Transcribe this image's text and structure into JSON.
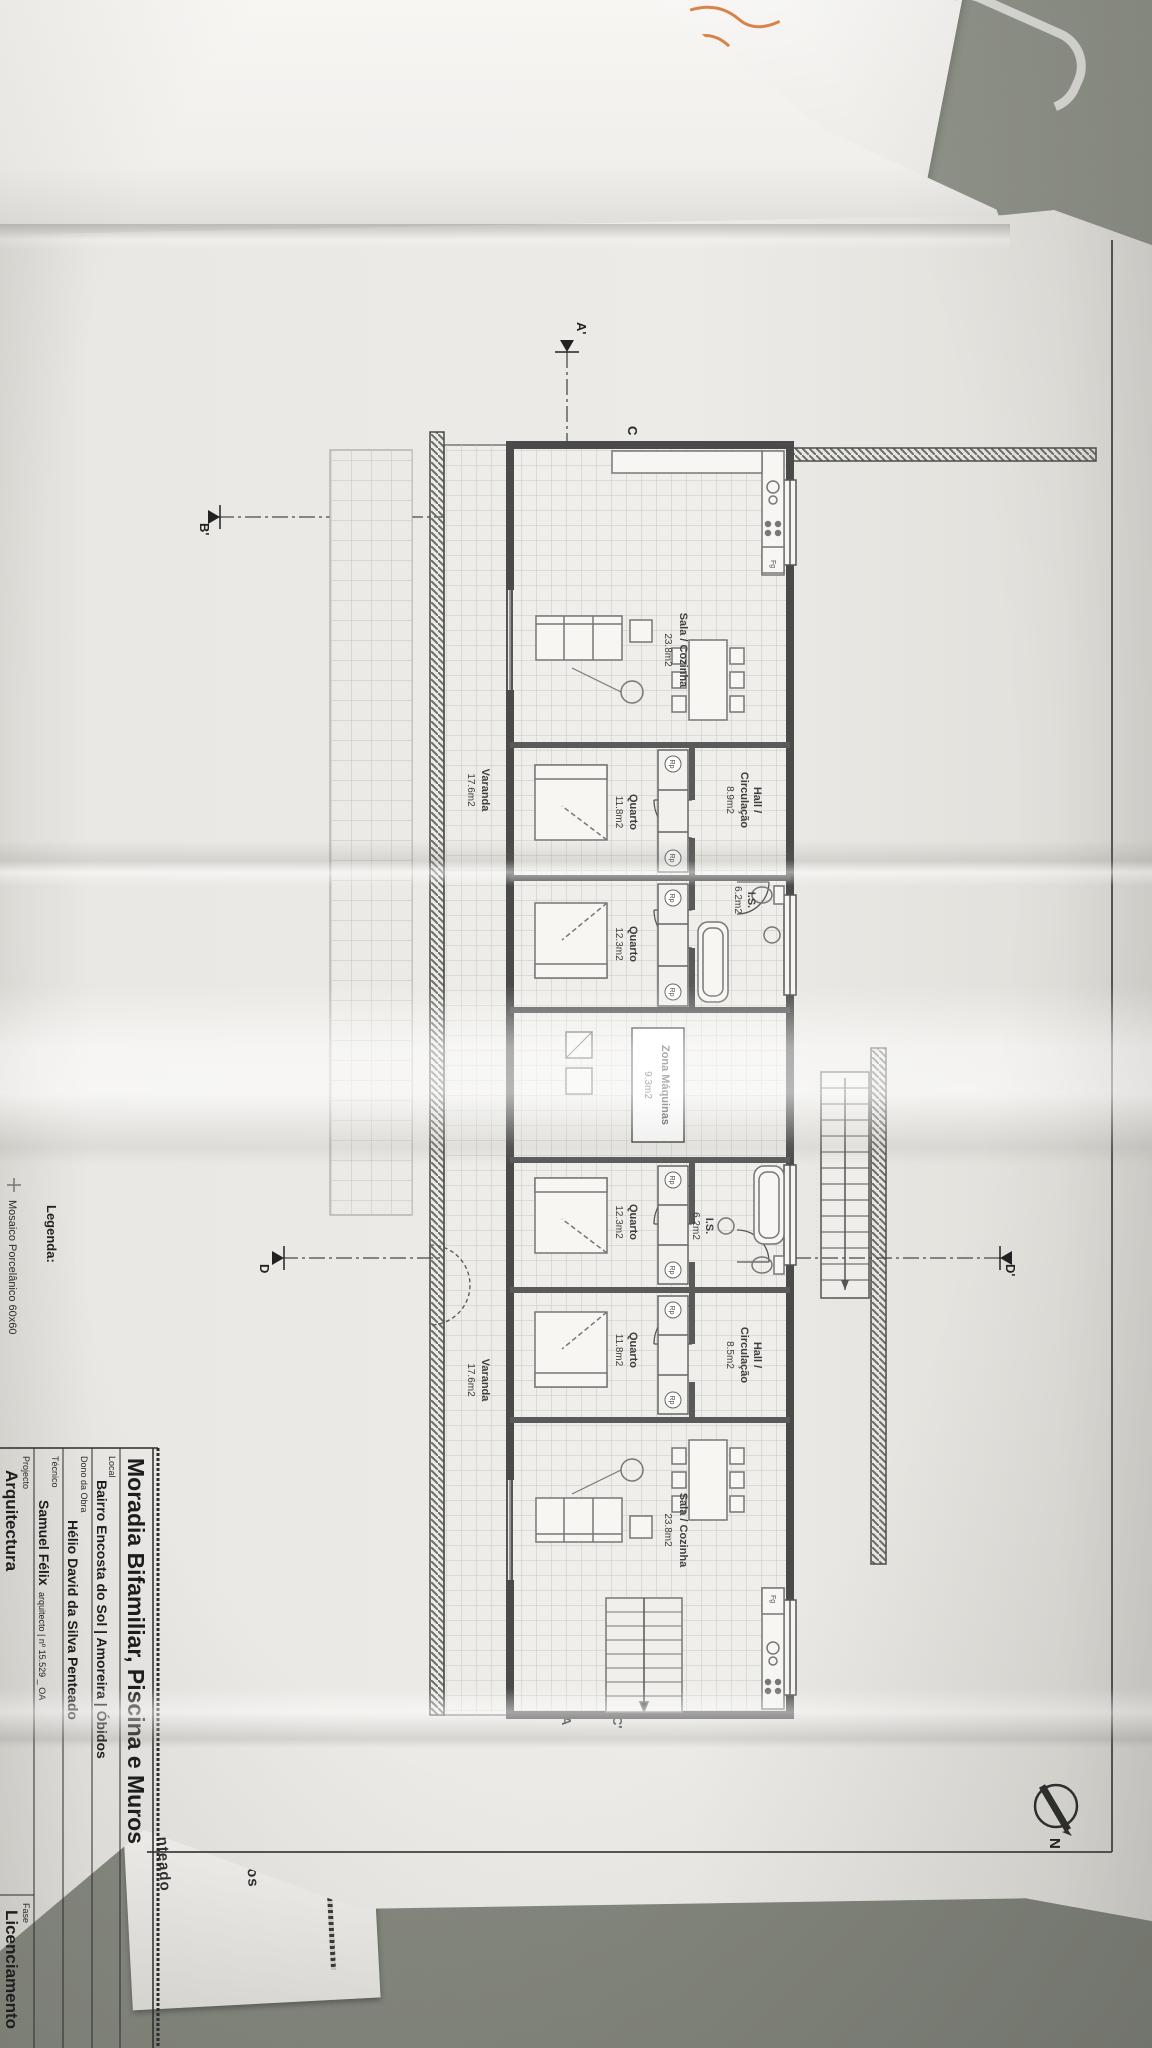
{
  "photo": {
    "desk_color": "#8b8e84",
    "paper_color": "#edebe7",
    "note_color": "#d9834a"
  },
  "sheet": {
    "north_label": "N",
    "legend": {
      "heading": "Legenda:",
      "item_1": "Mosaico Porcelânico 60x60"
    },
    "title_block": {
      "title": "Moradia Bifamiliar, Piscina e Muros",
      "local_label": "Local",
      "local_value": "Bairro Encosta do Sol | Amoreira | Óbidos",
      "dono_label": "Dono da Obra",
      "dono_value": "Hélio David da Silva Penteado",
      "tecnico_label": "Técnico",
      "tecnico_name": "Samuel Félix",
      "tecnico_detail": "arquitecto | nº 15.529 _ OA",
      "projecto_label": "Projecto",
      "projecto_value": "Arquitectura",
      "fase_label": "Fase",
      "fase_value": "Licenciamento"
    },
    "under_sheet": {
      "fragment_1": "Óbidos",
      "fragment_2": "nteado"
    }
  },
  "plan": {
    "codes": {
      "wardrobe": "Rp",
      "fridge": "Fg"
    },
    "zona": {
      "name": "Zona Máquinas",
      "area": "9.3m2"
    },
    "unit_a": {
      "sala": {
        "name": "Sala / Cozinha",
        "area": "23.8m2"
      },
      "hall": {
        "name_1": "Hall /",
        "name_2": "Circulação",
        "area": "8.9m2"
      },
      "quarto_1": {
        "name": "Quarto",
        "area": "11.8m2"
      },
      "quarto_2": {
        "name": "Quarto",
        "area": "12.3m2"
      },
      "is": {
        "name": "I.S.",
        "area": "6.2m2"
      },
      "varanda": {
        "name": "Varanda",
        "area": "17.6m2"
      }
    },
    "unit_b": {
      "sala": {
        "name": "Sala / Cozinha",
        "area": "23.8m2"
      },
      "hall": {
        "name_1": "Hall /",
        "name_2": "Circulação",
        "area": "8.5m2"
      },
      "quarto_1": {
        "name": "Quarto",
        "area": "11.8m2"
      },
      "quarto_2": {
        "name": "Quarto",
        "area": "12.3m2"
      },
      "is": {
        "name": "I.S.",
        "area": "6.2m2"
      },
      "varanda": {
        "name": "Varanda",
        "area": "17.6m2"
      }
    },
    "sections": {
      "a_start": "A'",
      "a_end": "A",
      "c_start": "C",
      "c_end": "C'",
      "b_start": "B",
      "b_end": "B'",
      "d_start": "D'",
      "d_end": "D"
    }
  }
}
